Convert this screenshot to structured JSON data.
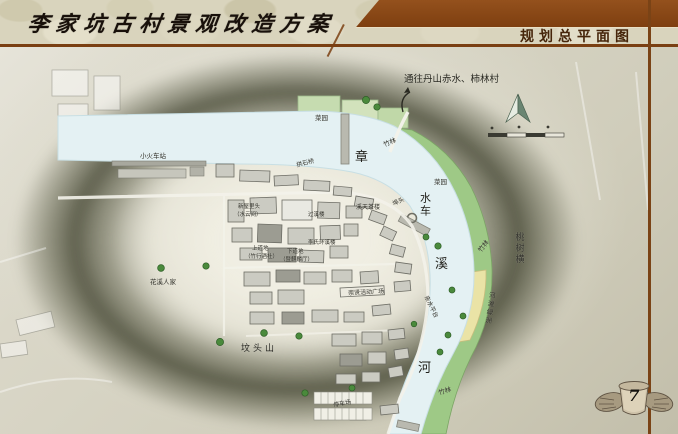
{
  "header": {
    "title": "李家坑古村景观改造方案",
    "section_title": "规划总平面图"
  },
  "page": {
    "number": "7"
  },
  "colors": {
    "accent_brown": "#7a3f12",
    "bar_brown": "#8a4a1a",
    "river": "#e4f1f3",
    "bank_green": "#9ec986",
    "shoal_yellow": "#eae3a6",
    "blob_olive": "#5e604a"
  },
  "map": {
    "labels": [
      {
        "text": "通往丹山赤水、柿林村",
        "x": 404,
        "y": 75,
        "size": 9.5,
        "color": "#26261e"
      },
      {
        "text": "菜园",
        "x": 315,
        "y": 116,
        "size": 6.5
      },
      {
        "text": "竹林",
        "x": 383,
        "y": 143,
        "size": 6.5,
        "rot": -22
      },
      {
        "text": "小火车站",
        "x": 140,
        "y": 154,
        "size": 6.5
      },
      {
        "text": "章",
        "x": 355,
        "y": 151,
        "size": 13,
        "serif": true,
        "color": "#1e1e18"
      },
      {
        "text": "拱石桥",
        "x": 296,
        "y": 163,
        "size": 6,
        "rot": -14
      },
      {
        "text": "菜园",
        "x": 434,
        "y": 180,
        "size": 6.5
      },
      {
        "text": "溪天茶楼",
        "x": 356,
        "y": 205,
        "size": 6
      },
      {
        "text": "埠头",
        "x": 392,
        "y": 202,
        "size": 6,
        "rot": -24
      },
      {
        "text": "水车",
        "x": 419,
        "y": 192,
        "size": 11,
        "serif": true,
        "vertical": true,
        "color": "#1e1e18"
      },
      {
        "text": "新屋里头",
        "x": 238,
        "y": 205,
        "size": 5.5
      },
      {
        "text": "（水云间）",
        "x": 234,
        "y": 213,
        "size": 5.5
      },
      {
        "text": "过溪楼",
        "x": 308,
        "y": 213,
        "size": 5.5
      },
      {
        "text": "李氏环溪楼",
        "x": 308,
        "y": 241,
        "size": 5.5
      },
      {
        "text": "上道地",
        "x": 252,
        "y": 247,
        "size": 5.5
      },
      {
        "text": "（竹行酒社）",
        "x": 245,
        "y": 255,
        "size": 5.5
      },
      {
        "text": "下道地",
        "x": 287,
        "y": 250,
        "size": 5.5
      },
      {
        "text": "（暨麒麟厅）",
        "x": 280,
        "y": 258,
        "size": 5.5
      },
      {
        "text": "花溪人家",
        "x": 150,
        "y": 280,
        "size": 6.5
      },
      {
        "text": "溪",
        "x": 435,
        "y": 258,
        "size": 13,
        "serif": true,
        "color": "#1e1e18"
      },
      {
        "text": "竹林",
        "x": 478,
        "y": 250,
        "size": 6.5,
        "rot": -52
      },
      {
        "text": "桃树横",
        "x": 513,
        "y": 232,
        "size": 9,
        "serif": true,
        "vertical": true,
        "color": "#30302a"
      },
      {
        "text": "崇贤活动广场",
        "x": 348,
        "y": 291,
        "size": 6,
        "rot": -3
      },
      {
        "text": "亲水平台",
        "x": 428,
        "y": 295,
        "size": 6,
        "rot": 64
      },
      {
        "text": "河滩绿洲",
        "x": 487,
        "y": 291,
        "size": 6.5,
        "vertical": true,
        "rot": 8
      },
      {
        "text": "坟头山",
        "x": 241,
        "y": 345,
        "size": 9,
        "serif": true,
        "ls": 3,
        "color": "#262620"
      },
      {
        "text": "河",
        "x": 418,
        "y": 362,
        "size": 13,
        "serif": true,
        "color": "#1e1e18"
      },
      {
        "text": "竹林",
        "x": 438,
        "y": 391,
        "size": 6.5,
        "rot": -16
      },
      {
        "text": "停车场",
        "x": 333,
        "y": 403,
        "size": 6,
        "rot": -10
      }
    ]
  }
}
